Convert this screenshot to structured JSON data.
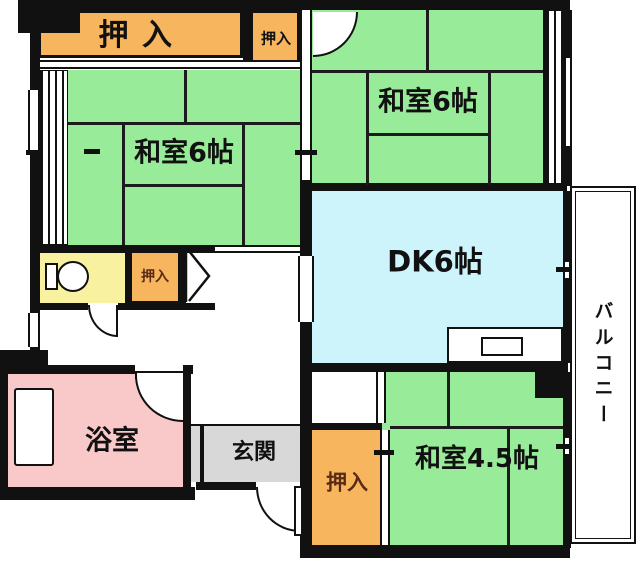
{
  "page": {
    "type": "apartment-floor-plan"
  },
  "colors": {
    "wall": "#111111",
    "tatami_green": "#98EB98",
    "closet_orange": "#F7B55E",
    "dk_blue": "#CDF4FA",
    "bath_pink": "#F9C9C9",
    "toilet_yellow": "#F8F2A0",
    "genkan_gray": "#D8D8D8",
    "balcony_white": "#FFFFFF",
    "label_dark": "#111111",
    "label_brown": "#5A2A17"
  },
  "rooms": {
    "closet_top_left": {
      "label": "押入"
    },
    "closet_top_small": {
      "label": "押入"
    },
    "washitsu_left": {
      "label": "和室6帖"
    },
    "washitsu_top_right": {
      "label": "和室6帖"
    },
    "dk": {
      "label": "DK6帖"
    },
    "balcony": {
      "label": "バルコニー"
    },
    "washitsu_bottom_right": {
      "label": "和室4.5帖"
    },
    "closet_bottom": {
      "label": "押入"
    },
    "bathroom": {
      "label": "浴室"
    },
    "genkan": {
      "label": "玄関"
    },
    "closet_mid": {
      "label": "押入"
    }
  },
  "fixtures": {
    "toilet": "toilet-icon",
    "bathtub": "bathtub-icon",
    "kitchen_sink": "kitchen-sink-icon"
  }
}
